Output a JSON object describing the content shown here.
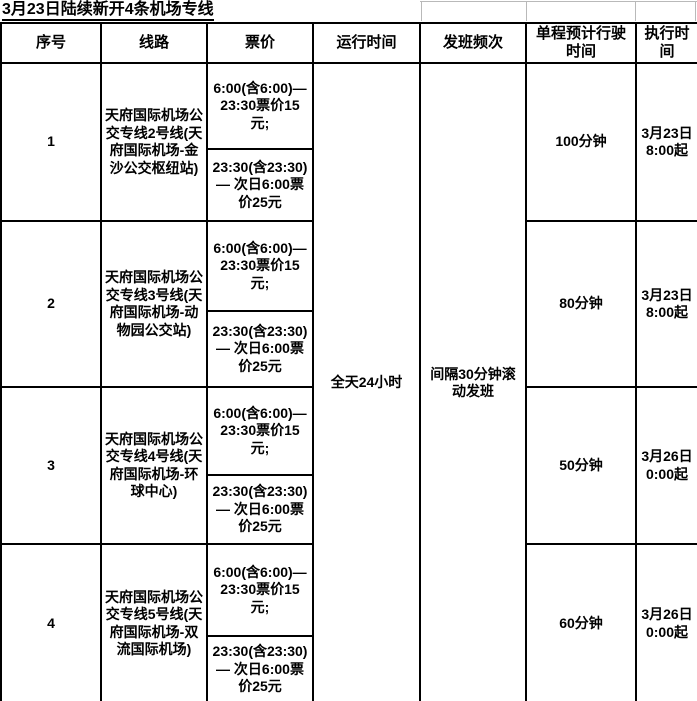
{
  "title": "3月23日陆续新开4条机场专线",
  "table": {
    "headers": [
      "序号",
      "线路",
      "票价",
      "运行时间",
      "发班频次",
      "单程预计行驶时间",
      "执行时间"
    ],
    "merged": {
      "operating_time": "全天24小时",
      "frequency": "间隔30分钟滚动发班"
    },
    "rows": [
      {
        "no": "1",
        "line": "天府国际机场公交专线2号线(天府国际机场-金沙公交枢纽站)",
        "fare_day": "6:00(含6:00)—23:30票价15元;",
        "fare_night": "23:30(含23:30)— 次日6:00票价25元",
        "duration": "100分钟",
        "effective": "3月23日8:00起"
      },
      {
        "no": "2",
        "line": "天府国际机场公交专线3号线(天府国际机场-动物园公交站)",
        "fare_day": "6:00(含6:00)—23:30票价15元;",
        "fare_night": "23:30(含23:30)— 次日6:00票价25元",
        "duration": "80分钟",
        "effective": "3月23日8:00起"
      },
      {
        "no": "3",
        "line": "天府国际机场公交专线4号线(天府国际机场-环球中心)",
        "fare_day": "6:00(含6:00)—23:30票价15元;",
        "fare_night": "23:30(含23:30)— 次日6:00票价25元",
        "duration": "50分钟",
        "effective": "3月26日0:00起"
      },
      {
        "no": "4",
        "line": "天府国际机场公交专线5号线(天府国际机场-双流国际机场)",
        "fare_day": "6:00(含6:00)—23:30票价15元;",
        "fare_night": "23:30(含23:30)— 次日6:00票价25元",
        "duration": "60分钟",
        "effective": "3月26日0:00起"
      }
    ]
  }
}
